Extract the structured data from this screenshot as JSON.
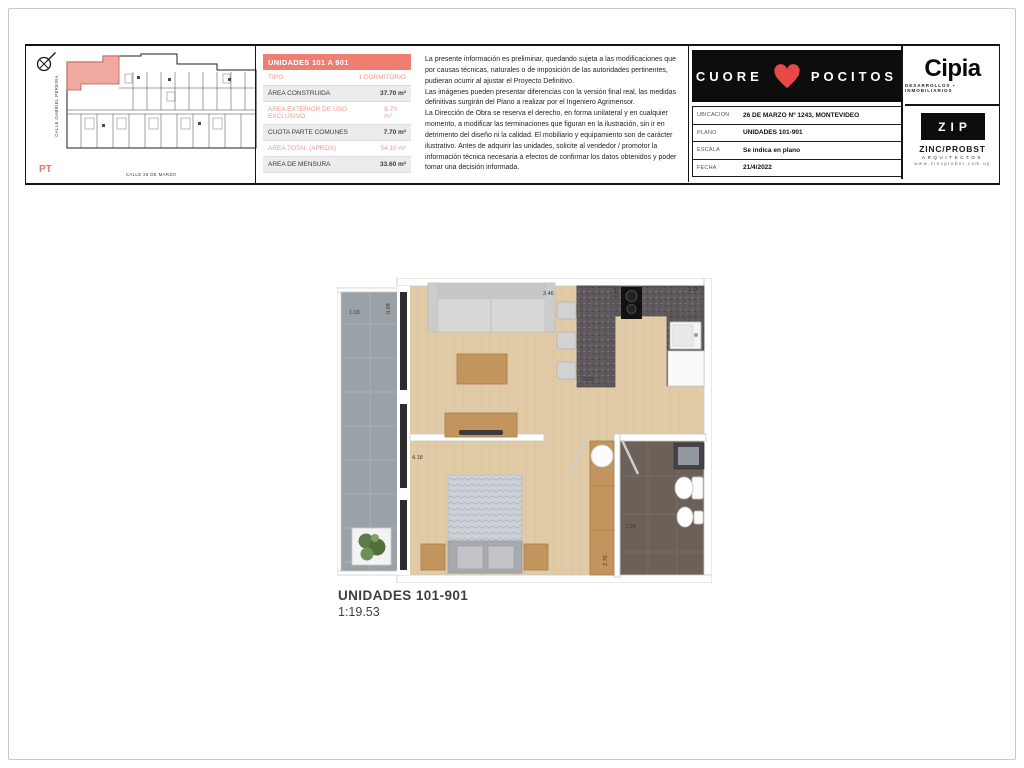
{
  "colors": {
    "accent": "#ee7e72",
    "accent_text": "#e89a8d",
    "heart_red": "#e94848",
    "wood_floor": "#e0cba6",
    "balcony_gray": "#9ba2a7",
    "counter_granite": "#5e585c",
    "bath_tile": "#6b6158"
  },
  "key_plan": {
    "street_left": "CALLE GABRIEL PEREIRA",
    "street_bottom": "CALLE 26 DE MARZO",
    "level": "PT"
  },
  "unit_table": {
    "title": "UNIDADES 101 A 901",
    "rows": [
      {
        "label": "TIPO",
        "value": "1 DORMITORIO"
      },
      {
        "label": "ÁREA CONSTRUIDA",
        "value": "37.70 m²"
      },
      {
        "label": "AREA EXTERIOR DE USO EXCLUSIVO",
        "value": "8.70 m²"
      },
      {
        "label": "CUOTA PARTE COMUNES",
        "value": "7.70 m²"
      },
      {
        "label": "AREA TOTAL (APROX)",
        "value": "54.10 m²"
      },
      {
        "label": "AREA DE MENSURA",
        "value": "33.60 m²"
      }
    ]
  },
  "disclaimer": {
    "p1": "La presente información es preliminar, quedando sujeta a las modificaciones que por causas técnicas, naturales o de imposición de las autoridades pertinentes, pudieran ocurrir al ajustar el Proyecto Definitivo.",
    "p2": "Las imágenes pueden presentar diferencias con la versión final real, las medidas definitivas surgirán del Plano a realizar por el Ingeniero Agrimensor.",
    "p3": "La Dirección de Obra se reserva el derecho, en forma unilateral y en cualquier momento, a modificar las terminaciones que figuran en la ilustración, sin ir en detrimento del diseño ni la calidad. El mobiliario y equipamiento son de carácter ilustrativo. Antes de adquirir las unidades, solicite al vendedor / promotor la información técnica necesaria a efectos de confirmar los datos obtenidos y poder tomar una decisión informada."
  },
  "title_block": {
    "brand_left": "CUORE",
    "brand_right": "POCITOS",
    "developer_name": "Cipia",
    "developer_tagline": "DESARROLLOS ▪ INMOBILIARIOS",
    "architect_logo": "ZIP",
    "architect_name": "ZINC/PROBST",
    "architect_role": "ARQUITECTOS",
    "architect_web": "www.zincprobst.com.uy",
    "fields": [
      {
        "label": "UBICACION",
        "value": "26 DE MARZO Nº 1243, MONTEVIDEO"
      },
      {
        "label": "PLANO",
        "value": "UNIDADES 101-901"
      },
      {
        "label": "ESCALA",
        "value": "Se indica en plano"
      },
      {
        "label": "FECHA",
        "value": "21/4/2022"
      }
    ]
  },
  "floor_plan": {
    "caption_title": "UNIDADES 101-901",
    "caption_scale": "1:19.53",
    "dims": {
      "balcony": "1.03",
      "balcony_side": "0.98",
      "kitchen_bar": "3.46",
      "kitchen_top": "2.98",
      "kitchen_right": "2.15",
      "kitchen_depth": "0.90",
      "bedroom": "4.18",
      "wardrobe": "2.70",
      "bath": "1.34"
    }
  }
}
